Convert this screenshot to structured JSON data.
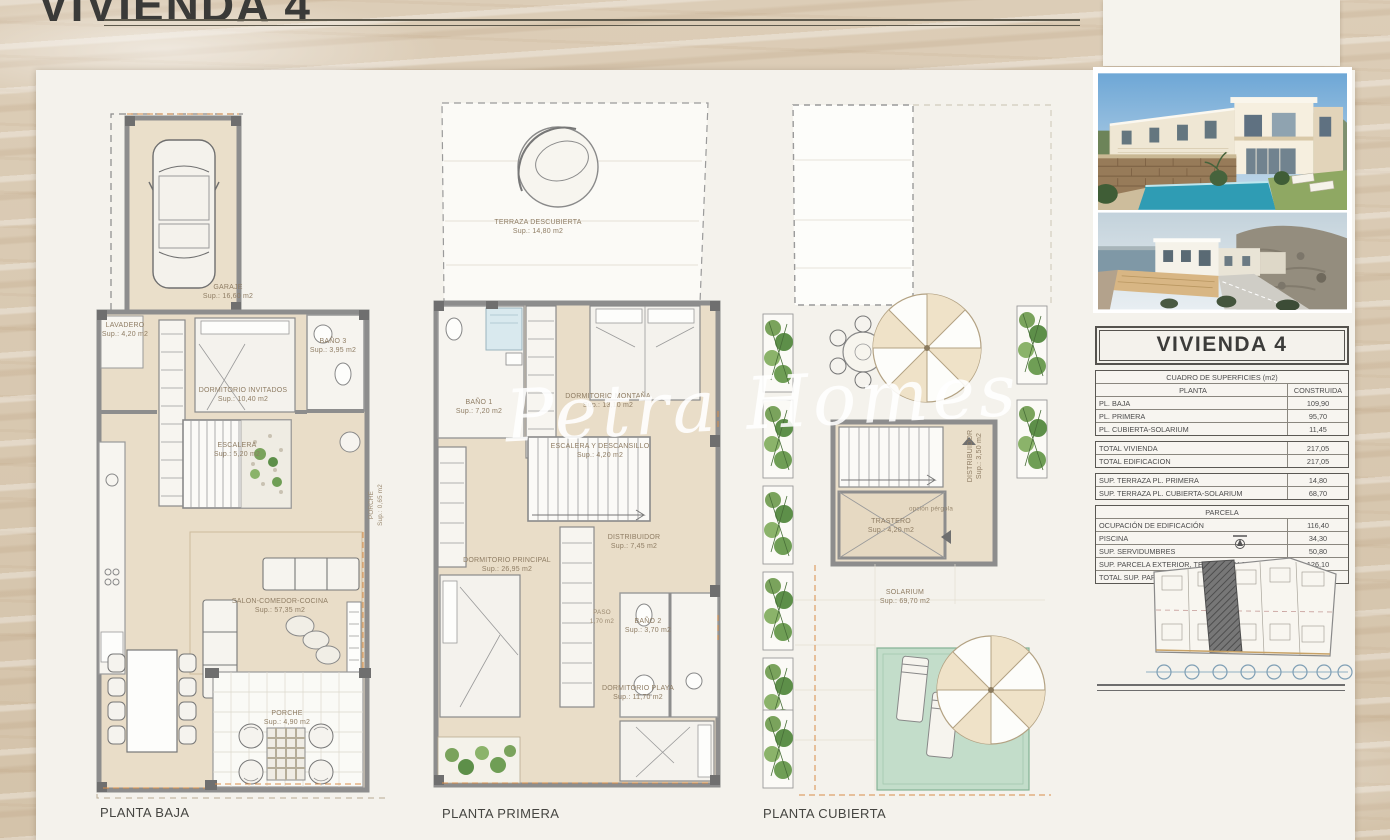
{
  "page": {
    "title": "VIVIENDA 4",
    "watermark": "Petra Homes"
  },
  "plans": [
    {
      "caption": "PLANTA BAJA",
      "rooms": [
        {
          "name": "GARAJE",
          "sup": "Sup.: 16,60 m2"
        },
        {
          "name": "LAVADERO",
          "sup": "Sup.: 4,20 m2"
        },
        {
          "name": "DORMITORIO INVITADOS",
          "sup": "Sup.: 10,40 m2"
        },
        {
          "name": "BAÑO 3",
          "sup": "Sup.: 3,95 m2"
        },
        {
          "name": "ESCALERA",
          "sup": "Sup.: 5,20 m2"
        },
        {
          "name": "PORCHE",
          "sup": "Sup.: 0,65 m2"
        },
        {
          "name": "SALON-COMEDOR-COCINA",
          "sup": "Sup.: 57,35 m2"
        },
        {
          "name": "PORCHE",
          "sup": "Sup.: 4,90 m2"
        }
      ]
    },
    {
      "caption": "PLANTA PRIMERA",
      "rooms": [
        {
          "name": "TERRAZA DESCUBIERTA",
          "sup": "Sup.: 14,80 m2"
        },
        {
          "name": "BAÑO 1",
          "sup": "Sup.: 7,20 m2"
        },
        {
          "name": "DORMITORIO MONTAÑA",
          "sup": "Sup.: 13,10 m2"
        },
        {
          "name": "ESCALERA Y DESCANSILLO",
          "sup": "Sup.: 4,20 m2"
        },
        {
          "name": "DORMITORIO PRINCIPAL",
          "sup": "Sup.: 26,95 m2"
        },
        {
          "name": "DISTRIBUIDOR",
          "sup": "Sup.: 7,45 m2"
        },
        {
          "name": "PASO",
          "sup": "1,70 m2"
        },
        {
          "name": "BAÑO 2",
          "sup": "Sup.: 3,70 m2"
        },
        {
          "name": "DORMITORIO PLAYA",
          "sup": "Sup.: 11,70 m2"
        }
      ]
    },
    {
      "caption": "PLANTA CUBIERTA",
      "rooms": [
        {
          "name": "DISTRIBUIDOR",
          "sup": "Sup.: 3,50 m2"
        },
        {
          "name": "TRASTERO",
          "sup": "Sup.: 4,20 m2"
        },
        {
          "name": "opción pérgola",
          "sup": ""
        },
        {
          "name": "SOLARIUM",
          "sup": "Sup.: 69,70 m2"
        }
      ]
    }
  ],
  "summary": {
    "title": "VIVIENDA 4",
    "header": "CUADRO DE SUPERFICIES (m2)",
    "col_planta": "PLANTA",
    "col_construida": "CONSTRUIDA",
    "rows": [
      {
        "label": "PL. BAJA",
        "value": "109,90"
      },
      {
        "label": "PL. PRIMERA",
        "value": "95,70"
      },
      {
        "label": "PL. CUBIERTA-SOLARIUM",
        "value": "11,45"
      }
    ],
    "totals": [
      {
        "label": "TOTAL VIVIENDA",
        "value": "217,05"
      },
      {
        "label": "TOTAL EDIFICACION",
        "value": "217,05"
      }
    ],
    "terrazas": [
      {
        "label": "SUP. TERRAZA PL. PRIMERA",
        "value": "14,80"
      },
      {
        "label": "SUP. TERRAZA PL. CUBIERTA-SOLARIUM",
        "value": "68,70"
      }
    ],
    "parcela_header": "PARCELA",
    "parcela_rows": [
      {
        "label": "OCUPACIÓN DE EDIFICACIÓN",
        "value": "116,40"
      },
      {
        "label": "PISCINA",
        "value": "34,30"
      },
      {
        "label": "SUP. SERVIDUMBRES",
        "value": "50,80"
      },
      {
        "label": "SUP. PARCELA EXTERIOR, TERRAZAS Y JARDINES",
        "value": "126,10"
      },
      {
        "label": "TOTAL SUP. PARCELA",
        "value": "327,60"
      }
    ]
  }
}
